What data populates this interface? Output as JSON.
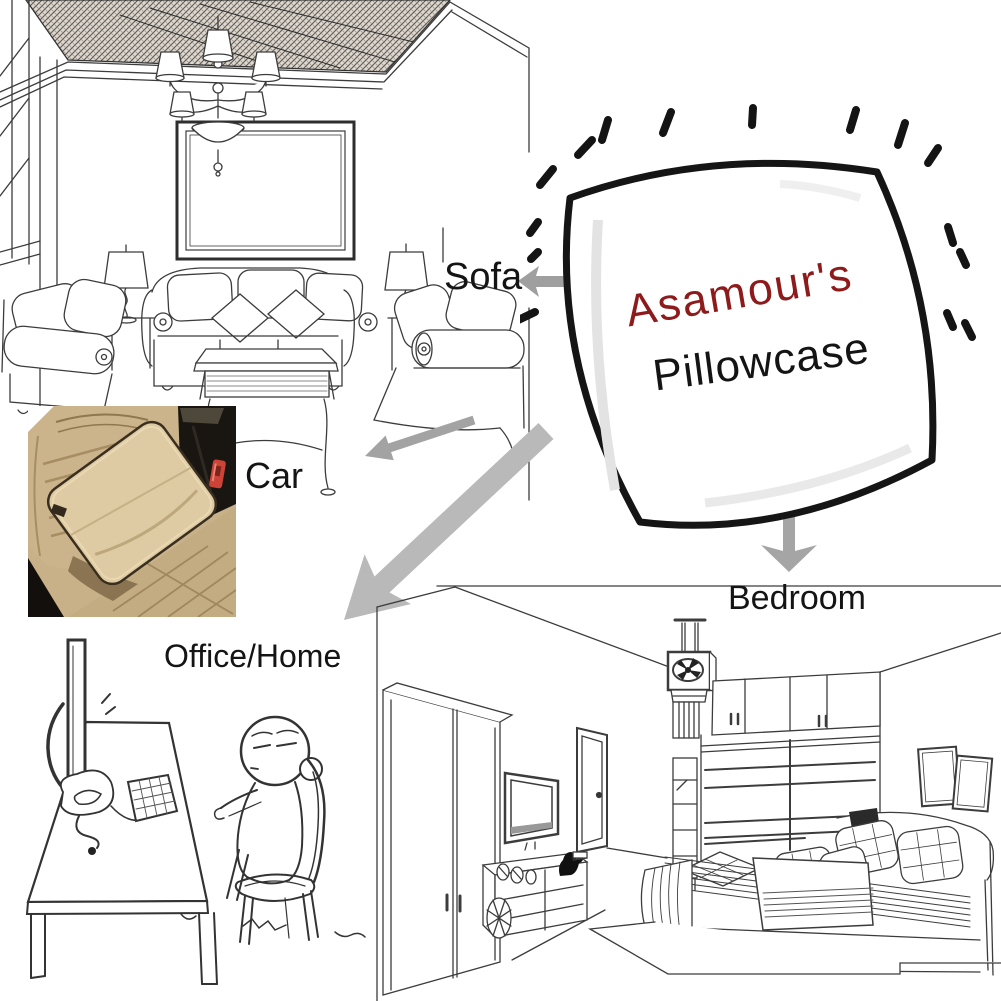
{
  "pillow": {
    "brand": "Asamour's",
    "product": "Pillowcase"
  },
  "labels": {
    "sofa": "Sofa",
    "car": "Car",
    "office": "Office/Home",
    "bedroom": "Bedroom"
  },
  "colors": {
    "brand_text": "#8e1b1b",
    "product_text": "#141414",
    "label_text": "#141414",
    "arrow_gray": "#a3a3a3",
    "arrow_big_gray": "#b9b9b9",
    "line_art": "#3c3c3c",
    "car_seat_beige": "#c8b088",
    "car_pillow_beige": "#decaa3",
    "car_piping_brown": "#3a2f1f",
    "car_buckle_red": "#cc4437",
    "car_shadow_black": "#191511"
  },
  "icons": {
    "arrow_to_sofa": "left-arrow",
    "arrow_to_car": "down-left-arrow",
    "arrow_to_office": "down-left-arrow-large",
    "arrow_to_bedroom": "down-arrow",
    "burst": "radiating-dashes"
  },
  "scenes": {
    "living_room": "living-room-line-art",
    "car": "car-seat-pillow-photo",
    "office": "office-desk-cartoon",
    "bedroom": "bedroom-line-art"
  }
}
